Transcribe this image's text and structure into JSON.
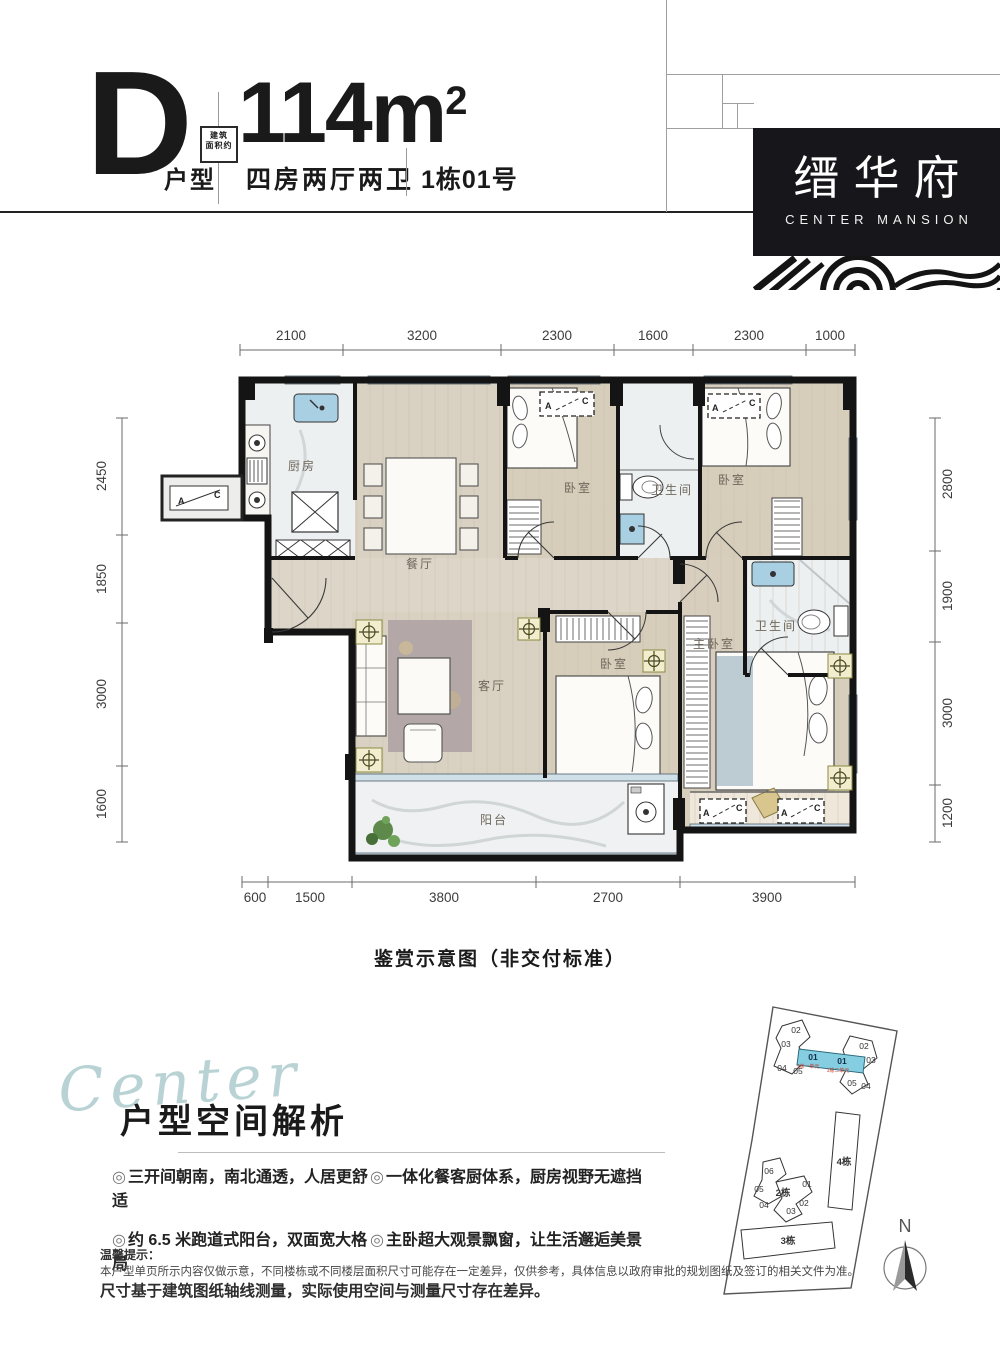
{
  "header": {
    "unit_letter": "D",
    "unit_suffix": "户型",
    "area_tag_line1": "建筑",
    "area_tag_line2": "面积约",
    "area_value": "114m",
    "area_sup": "2",
    "rooms_line": "四房两厅两卫",
    "building_no": "1栋01号"
  },
  "logo": {
    "name_cn": "缙华府",
    "name_en": "CENTER MANSION"
  },
  "plan": {
    "caption": "鉴赏示意图（非交付标准）",
    "dims": {
      "top": [
        "2100",
        "3200",
        "2300",
        "1600",
        "2300",
        "1000"
      ],
      "left": [
        "2450",
        "1850",
        "3000",
        "1600"
      ],
      "right": [
        "2800",
        "1900",
        "3000",
        "1200"
      ],
      "bottom": [
        "600",
        "1500",
        "3800",
        "2700",
        "3900"
      ]
    },
    "rooms": {
      "kitchen": "厨房",
      "dining": "餐厅",
      "living": "客厅",
      "balcony": "阳台",
      "master": "主卧室",
      "bedroom": "卧室",
      "bath": "卫生间"
    },
    "ac": {
      "a": "A",
      "c": "C"
    }
  },
  "analysis": {
    "script_word": "Center",
    "title": "户型空间解析",
    "marker": "◎",
    "bullets": [
      "三开间朝南，南北通透，人居更舒适",
      "约 6.5 米跑道式阳台，双面宽大格局",
      "一体化餐客厨体系，厨房视野无遮挡",
      "主卧超大观景飘窗，让生活邂逅美景"
    ]
  },
  "siteplan": {
    "b1_left_units": [
      "02",
      "03",
      "04",
      "05"
    ],
    "b1_center_units": [
      "01",
      "01"
    ],
    "b1_red_labels": [
      "1栋一单元",
      "1栋二单元"
    ],
    "b1_right_units": [
      "02",
      "03",
      "05",
      "04"
    ],
    "b2_units": [
      "06",
      "05",
      "01",
      "04",
      "03",
      "02"
    ],
    "b2_label": "2栋",
    "b3_label": "3栋",
    "b4_label": "4栋",
    "north": "N",
    "highlight_color": "#85cde0"
  },
  "disclaimer": {
    "title": "温馨提示：",
    "line1": "本户型单页所示内容仅做示意，不同楼栋或不同楼层面积尺寸可能存在一定差异，仅供参考，具体信息以政府审批的规划图纸及签订的相关文件为准。",
    "line2": "尺寸基于建筑图纸轴线测量，实际使用空间与测量尺寸存在差异。"
  }
}
